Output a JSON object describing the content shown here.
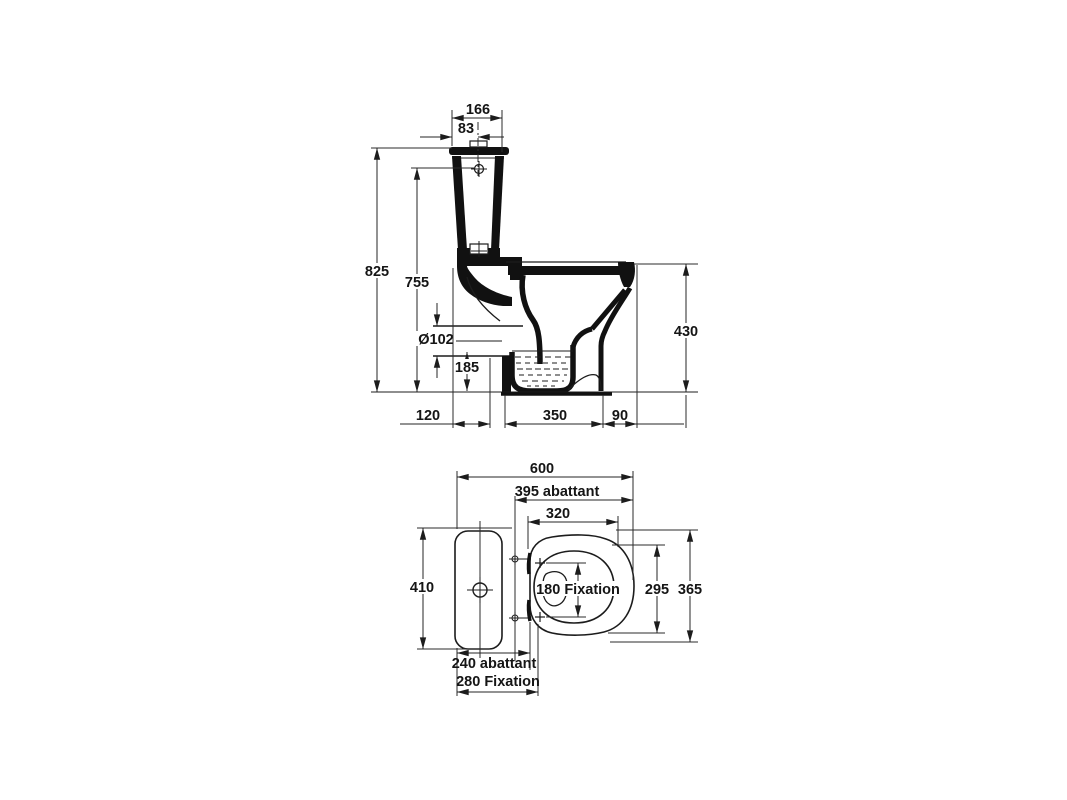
{
  "document": {
    "type": "sanitary technical drawing",
    "subject": "close-coupled WC pan with cistern, side elevation and plan view",
    "background_color": "#ffffff",
    "line_color": "#1c1c1c"
  },
  "side_view": {
    "labels": {
      "tank_depth": "166",
      "tank_center_offset": "83",
      "total_height": "825",
      "inlet_height": "755",
      "outlet_diameter": "Ø102",
      "outlet_axis_height": "185",
      "bowl_height": "430",
      "rear_to_outlet": "120",
      "outlet_to_front": "350",
      "front_lip": "90"
    }
  },
  "top_view": {
    "labels": {
      "total_depth": "600",
      "seat_depth": "395 abattant",
      "opening_depth": "320",
      "tank_width": "410",
      "fixation_spacing": "180 Fixation",
      "opening_width": "295",
      "overall_width": "365",
      "seat_hinge_width": "240 abattant",
      "fixation_width": "280 Fixation"
    }
  }
}
